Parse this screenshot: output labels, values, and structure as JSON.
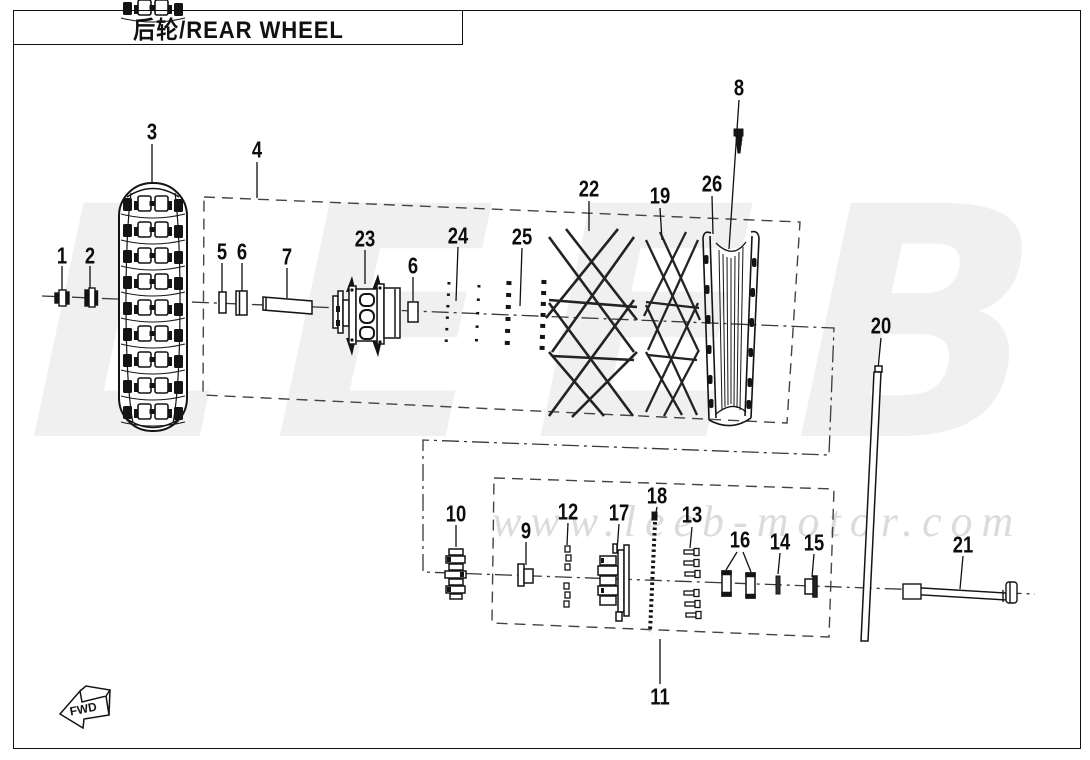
{
  "title": "后轮/REAR WHEEL",
  "watermark": {
    "brand": "LEEB",
    "url": "www.leeb-motor.com"
  },
  "direction_marker": "FWD",
  "callouts": [
    "1",
    "2",
    "3",
    "4",
    "5",
    "6",
    "7",
    "23",
    "6",
    "24",
    "25",
    "22",
    "19",
    "26",
    "8",
    "20",
    "10",
    "9",
    "12",
    "17",
    "18",
    "13",
    "16",
    "14",
    "15",
    "21",
    "11"
  ]
}
